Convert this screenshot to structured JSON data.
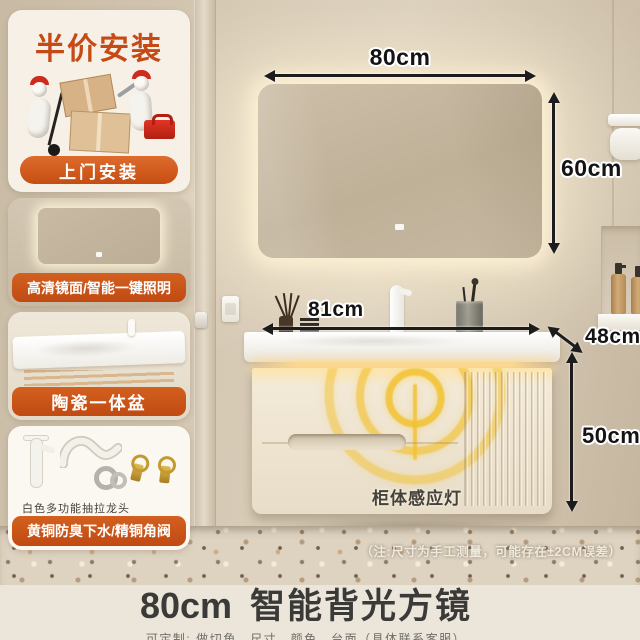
{
  "sidebar": {
    "promo_title": "半价安装",
    "install_button": "上门安装",
    "mirror_label": "高清镜面/智能一键照明",
    "basin_label": "陶瓷一体盆",
    "faucet_caption": "白色多功能抽拉龙头",
    "drain_label": "黄铜防臭下水/精铜角阀"
  },
  "dimensions": {
    "mirror_width": "80cm",
    "mirror_height": "60cm",
    "counter_width": "81cm",
    "counter_depth": "48cm",
    "cabinet_height": "50cm"
  },
  "scene": {
    "sensor_light_label": "柜体感应灯",
    "measurement_note": "（注:尺寸为手工测量，可能存在±2CM误差）"
  },
  "footer": {
    "size": "80cm",
    "product_name": "智能背光方镜",
    "customization_note": "可定制: 做切角、尺寸、颜色、台面（具体联系客服）"
  },
  "colors": {
    "accent_orange": "#cc5418",
    "promo_red": "#c64a16",
    "wall_beige": "#d3c6b2",
    "cabinet_cream": "#efe5d2",
    "sensor_gold": "#f0c43c"
  }
}
